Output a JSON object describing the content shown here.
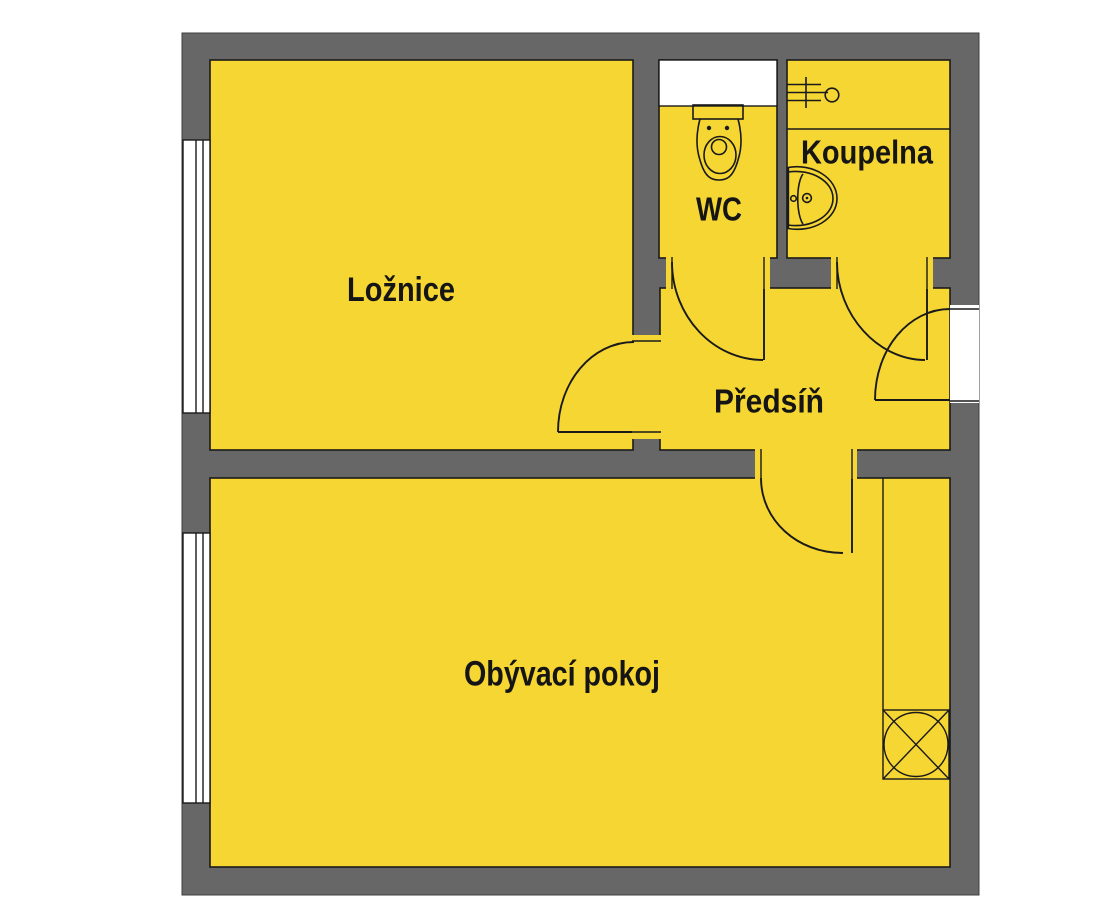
{
  "plan": {
    "colors": {
      "room_fill": "#F6D633",
      "wall_fill": "#676767",
      "line": "#1A1A1A",
      "opening_fill": "#FFFFFF"
    },
    "rooms": [
      {
        "id": "loznice",
        "label": "Ložnice"
      },
      {
        "id": "wc",
        "label": "WC"
      },
      {
        "id": "koupelna",
        "label": "Koupelna"
      },
      {
        "id": "predsin",
        "label": "Předsíň"
      },
      {
        "id": "obyvaci_pokoj",
        "label": "Obývací pokoj"
      }
    ],
    "fixtures": [
      {
        "id": "toilet",
        "icon": "toilet-icon",
        "room": "WC"
      },
      {
        "id": "washbasin",
        "icon": "washbasin-icon",
        "room": "Koupelna"
      },
      {
        "id": "water_connection",
        "icon": "faucet-connection-icon",
        "room": "Koupelna"
      },
      {
        "id": "ventilation_shaft",
        "icon": "ventilation-shaft-icon",
        "room": "Obývací pokoj"
      }
    ]
  }
}
